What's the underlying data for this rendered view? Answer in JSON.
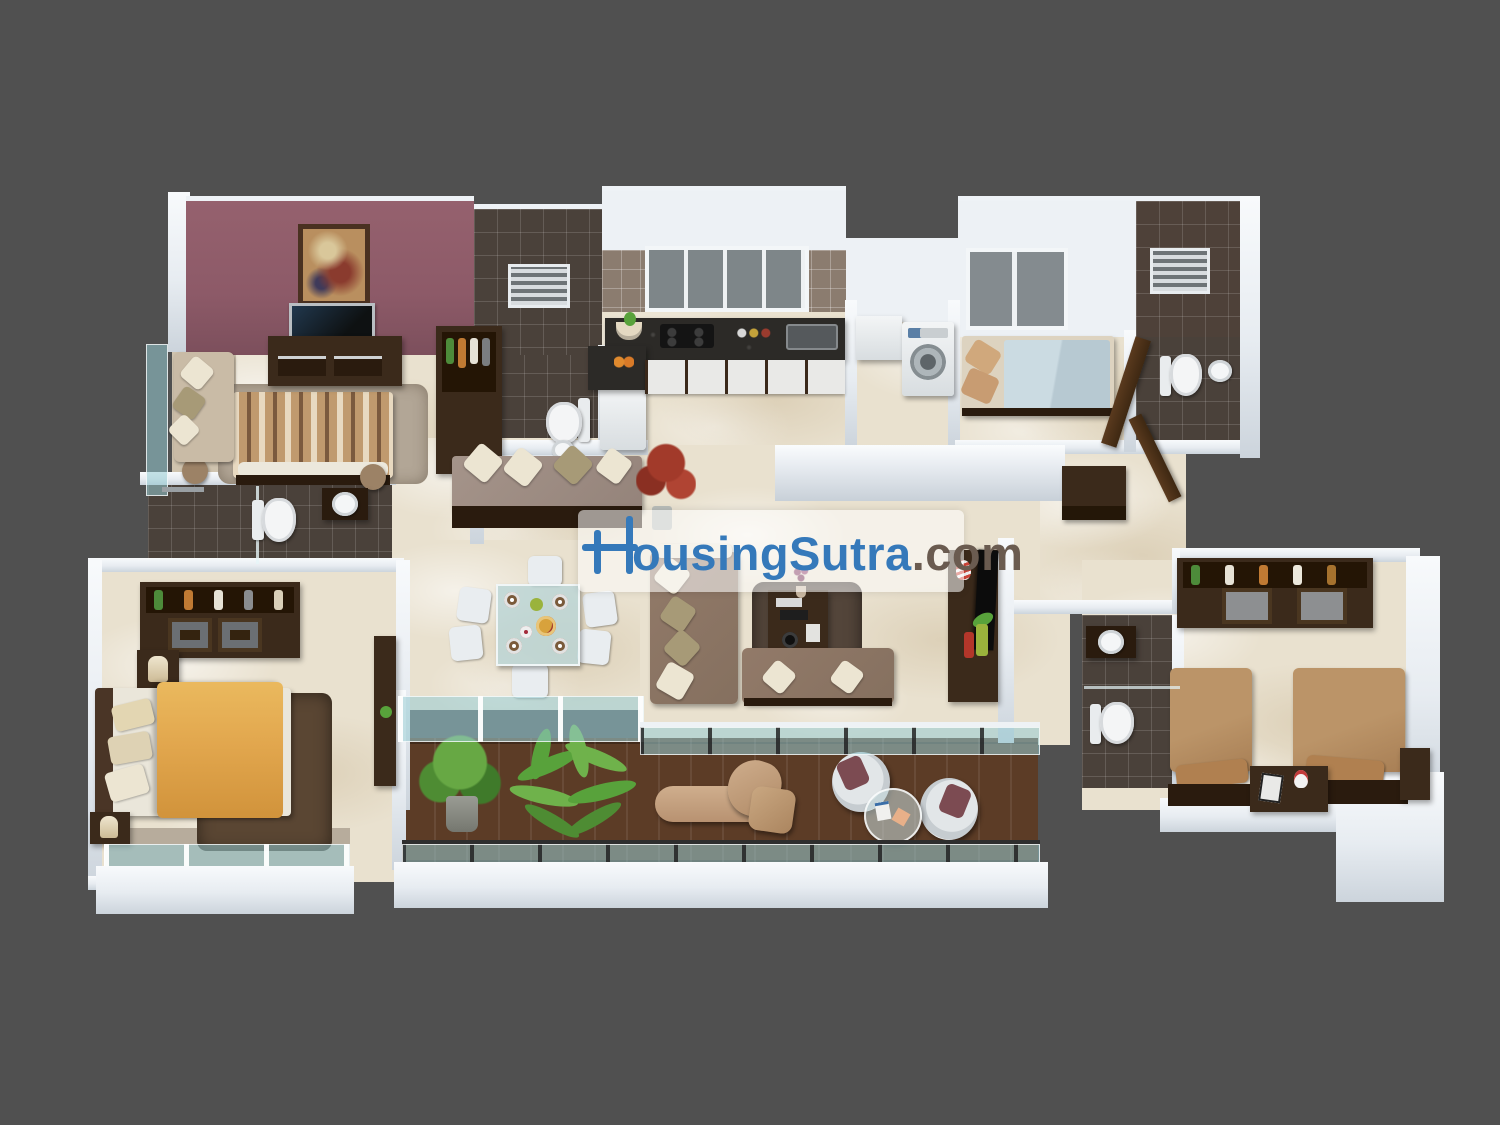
{
  "background_color": "#505050",
  "brand": {
    "full_text": "HousingSutra.com",
    "rest_blue": "ousingSutra",
    "tld": ".com",
    "blue": "#3579BA",
    "tld_color": "#6A5B50",
    "logo": "stylized-H-cross-mark"
  },
  "palette": {
    "marble_floor": "#E9E1CF",
    "white_wall": "#EDF1F5",
    "maroon_feature_wall": "#8D5A68",
    "dark_bathroom_tile": "#4A413A",
    "kitchen_wall_tile": "#8B7C6F",
    "granite_counter": "#2C2A27",
    "deck_wood": "#5C3C26",
    "glass_railing": "#98CCD4",
    "sofa_brown": "#8C7565",
    "master_bed_yellow": "#E2A74E",
    "guest_bed_blue": "#C2D2DA",
    "twin_bed_tan": "#B28A62",
    "furniture_dark_wood": "#3B2A1B"
  },
  "scene": {
    "type": "3d-floor-plan-render",
    "rooms": [
      {
        "name": "bedroom-1",
        "items": [
          "striped-double-bed",
          "tv-console",
          "wall-tv",
          "wall-painting",
          "wardrobe",
          "balcony-bench",
          "rug",
          "side-stools"
        ]
      },
      {
        "name": "bathroom-1",
        "items": [
          "toilet",
          "washbasin",
          "glass-shower-partition"
        ]
      },
      {
        "name": "powder-bathroom",
        "items": [
          "toilet",
          "washbasin",
          "louver-vent",
          "refrigerator"
        ]
      },
      {
        "name": "kitchen",
        "items": [
          "granite-l-counter",
          "gas-hob",
          "sink",
          "window",
          "cabinet-drawers",
          "fruit-bowl"
        ]
      },
      {
        "name": "utility",
        "items": [
          "washing-machine",
          "wash-counter"
        ]
      },
      {
        "name": "bedroom-2",
        "items": [
          "single-bed",
          "window"
        ]
      },
      {
        "name": "bathroom-2",
        "items": [
          "toilet",
          "washbasin",
          "louver-vent",
          "open-door"
        ]
      },
      {
        "name": "foyer",
        "items": [
          "settee-with-cushions",
          "red-plant"
        ]
      },
      {
        "name": "dining",
        "items": [
          "glass-dining-table",
          "six-chairs",
          "plates"
        ]
      },
      {
        "name": "living-room",
        "items": [
          "l-sofa",
          "loveseat",
          "coffee-table",
          "rug",
          "tv-unit",
          "flower-vase"
        ]
      },
      {
        "name": "hallway",
        "items": [
          "console-table",
          "open-doors"
        ]
      },
      {
        "name": "master-bedroom",
        "items": [
          "double-bed-yellow",
          "wardrobe",
          "nightstands",
          "lamps",
          "dresser",
          "rug",
          "balcony"
        ]
      },
      {
        "name": "bedroom-3",
        "items": [
          "twin-bed-left",
          "twin-bed-right",
          "nightstand",
          "mirrored-wardrobe"
        ]
      },
      {
        "name": "bathroom-3",
        "items": [
          "toilet",
          "round-basin",
          "vanity",
          "glass-partition"
        ]
      },
      {
        "name": "balcony-deck",
        "items": [
          "wood-deck",
          "glass-railing",
          "potted-plant",
          "palm-plant",
          "chaise-lounge",
          "ottoman",
          "egg-chair-left",
          "egg-chair-right",
          "round-glass-table"
        ]
      }
    ]
  }
}
